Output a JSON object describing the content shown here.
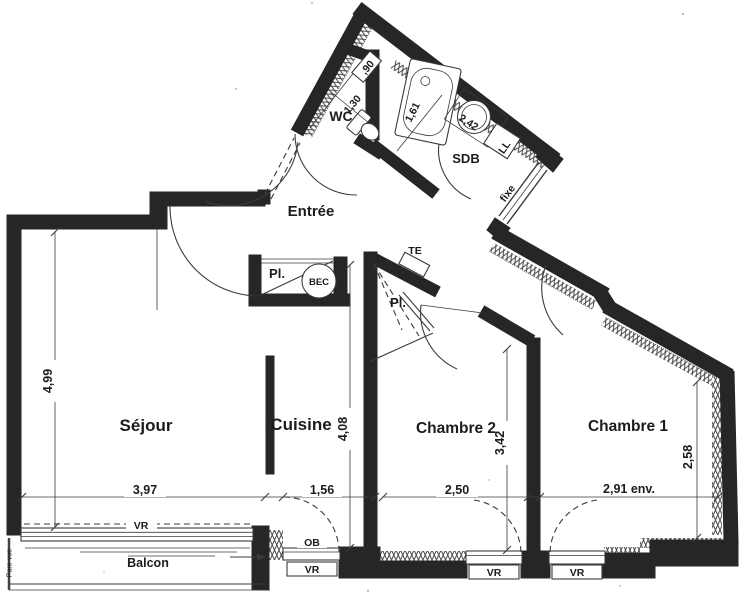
{
  "plan": {
    "rooms": {
      "sejour": "Séjour",
      "cuisine": "Cuisine",
      "chambre2": "Chambre 2",
      "chambre1": "Chambre 1",
      "entree": "Entrée",
      "wc": "WC",
      "sdb": "SDB",
      "balcon": "Balcon",
      "placard_entree": "Pl.",
      "placard_hall": "Pl."
    },
    "fixtures": {
      "bec": "BEC",
      "lave_linge": "LL",
      "tableau_electrique": "TE"
    },
    "openings": {
      "vr_sejour": "VR",
      "ob_cuisine": "OB",
      "vr_cuisine": "VR",
      "vr_chambre2": "VR",
      "vr_chambre1": "VR",
      "fixe": "fixe",
      "pare_vue": "Pare-vue"
    },
    "dimensions": {
      "sejour_depth": "4,99",
      "sejour_width": "3,97",
      "cuisine_width": "1,56",
      "cuisine_depth": "4,08",
      "chambre2_width": "2,50",
      "chambre2_depth": "3,42",
      "chambre1_width": "2,91 env.",
      "chambre1_depth": "2,58",
      "wc_depth": "1,30",
      "wc_width": ",90",
      "sdb_depth": "1,61",
      "sdb_width": "2,42"
    },
    "colors": {
      "wall": "#262626",
      "line": "#3b3b3b",
      "paper": "#ffffff"
    }
  }
}
